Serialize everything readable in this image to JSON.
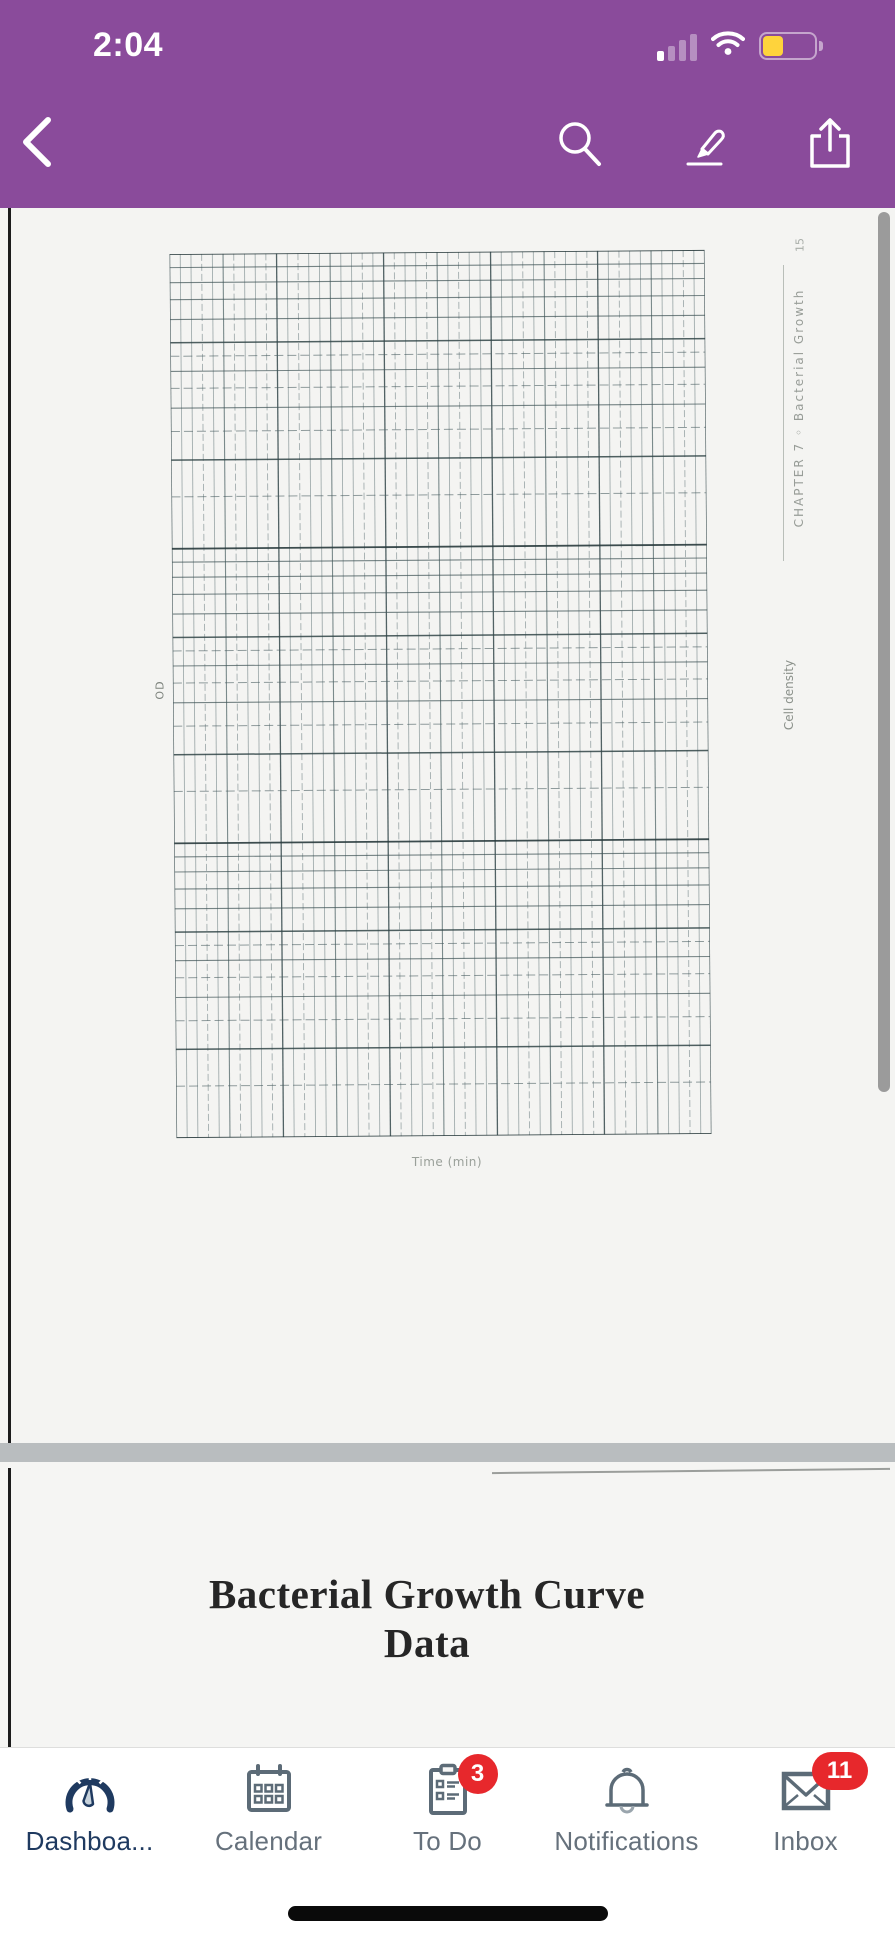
{
  "colors": {
    "header_purple": "#8a4b9b",
    "active_navy": "#1f3a60",
    "inactive_gray": "#5c6b77",
    "badge_red": "#e7282c",
    "battery_yellow": "#fed33c",
    "separator_gray": "#b9bdbf"
  },
  "status_bar": {
    "time": "2:04",
    "icons": [
      "cellular-signal-icon",
      "wifi-icon",
      "battery-icon"
    ]
  },
  "nav_bar": {
    "icons": [
      "back-chevron-icon",
      "search-icon",
      "annotate-highlighter-icon",
      "share-icon"
    ]
  },
  "document": {
    "page1": {
      "od_label": "OD",
      "cell_density_label": "Cell density",
      "time_label": "Time (min)",
      "chapter_label": "CHAPTER 7  ◦  Bacterial Growth",
      "page_number": "15",
      "grid": "empty semi-log graph paper, 3 decades, no data plotted"
    },
    "page2": {
      "title_line1": "Bacterial Growth Curve",
      "title_line2": "Data",
      "col_headers": [
        {
          "text": "Growth at 37",
          "sup": "0",
          "suffix": " C"
        },
        {
          "text": "Growth at 25",
          "sup": "0",
          "suffix": " C"
        }
      ]
    }
  },
  "tab_bar": {
    "items": [
      {
        "label": "Dashboa...",
        "icon": "dashboard-gauge-icon",
        "active": true
      },
      {
        "label": "Calendar",
        "icon": "calendar-icon"
      },
      {
        "label": "To Do",
        "icon": "todo-clipboard-icon",
        "badge": "3"
      },
      {
        "label": "Notifications",
        "icon": "notifications-bell-icon"
      },
      {
        "label": "Inbox",
        "icon": "inbox-envelope-icon",
        "badge": "11"
      }
    ]
  }
}
